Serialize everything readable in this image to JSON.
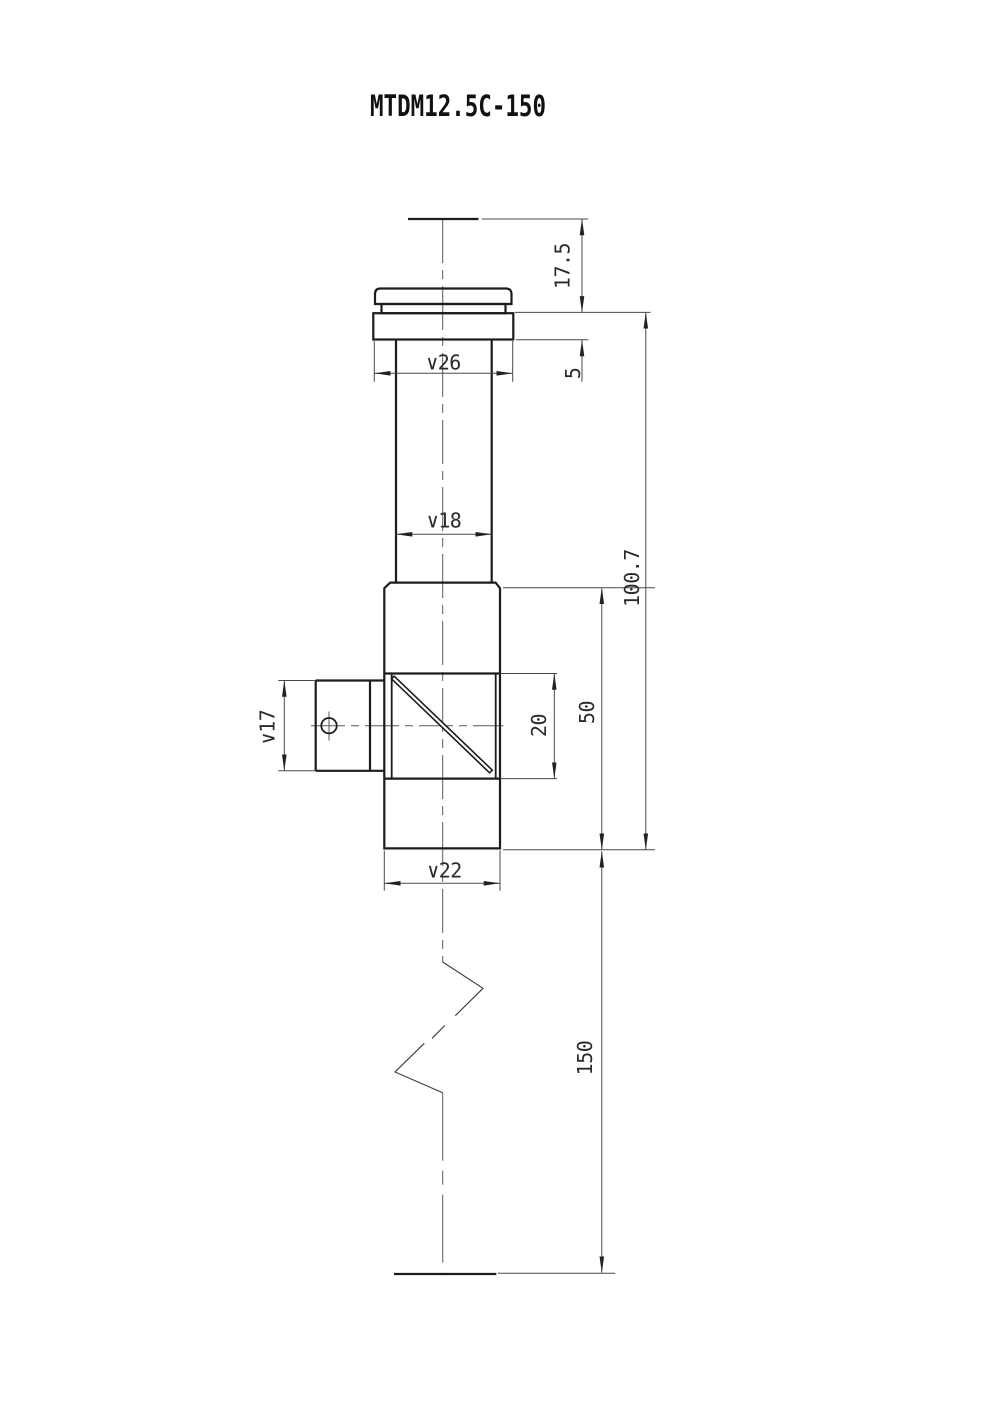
{
  "title": "MTDM12.5C-150",
  "dimensions": {
    "eye_relief": "17.5",
    "flange_height": "5",
    "flange_dia": "∨26",
    "tube_dia": "∨18",
    "overall_body_length": "100.7",
    "body_length": "50",
    "window_length": "20",
    "port_dia": "∨17",
    "body_dia": "∨22",
    "insertion_length": "150"
  }
}
